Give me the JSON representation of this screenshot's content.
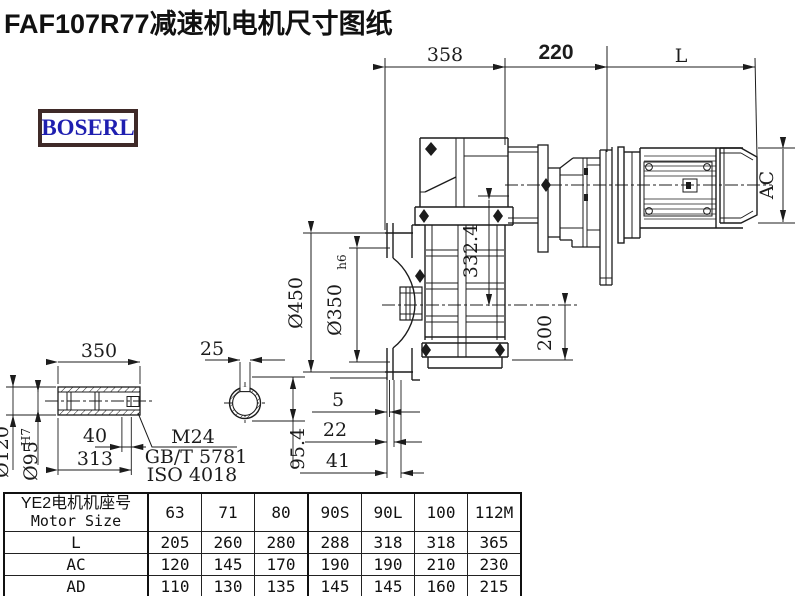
{
  "title": "FAF107R77减速机电机尺寸图纸",
  "logo": {
    "text": "BOSERL"
  },
  "colors": {
    "line": "#1c1c1c",
    "logo_text": "#1f1fb0",
    "logo_border": "#3f2a28",
    "bg": "#ffffff"
  },
  "dims": {
    "top_width_gearbox": "358",
    "top_width_adapter": "220",
    "top_width_motor": "L",
    "flange_od": "Ø450",
    "spigot_d": "Ø350",
    "spigot_tol": "h6",
    "center_height": "332.4",
    "base_height": "200",
    "motor_od": "AC",
    "axial_1": "5",
    "axial_2": "22",
    "axial_3": "41",
    "shaft_len": "350",
    "key_w": "25",
    "shaft_od": "Ø120",
    "bore_d": "Ø95",
    "bore_tol": "H7",
    "thread_depth": "40",
    "bore_len": "313",
    "key_h": "95.4",
    "thread": "M24",
    "thread_std1": "GB/T 5781",
    "thread_std2": "ISO 4018"
  },
  "table": {
    "header_cn": "YE2电机机座号",
    "header_en": "Motor Size",
    "columns": [
      "63",
      "71",
      "80",
      "90S",
      "90L",
      "100",
      "112M"
    ],
    "rows": [
      {
        "label": "L",
        "values": [
          "205",
          "260",
          "280",
          "288",
          "318",
          "318",
          "365"
        ]
      },
      {
        "label": "AC",
        "values": [
          "120",
          "145",
          "170",
          "190",
          "190",
          "210",
          "230"
        ]
      },
      {
        "label": "AD",
        "values": [
          "110",
          "130",
          "135",
          "145",
          "145",
          "160",
          "215"
        ]
      }
    ]
  }
}
